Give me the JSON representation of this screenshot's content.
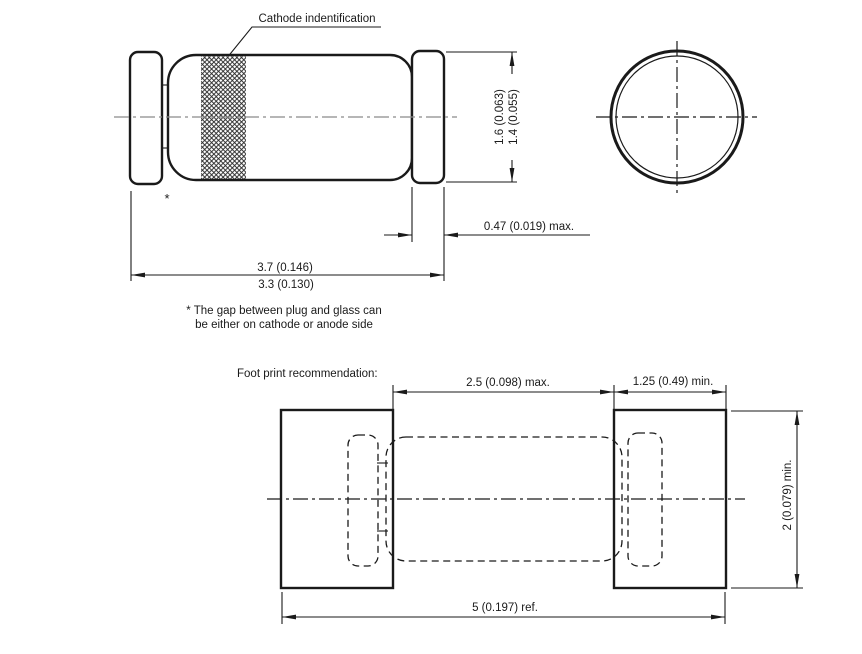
{
  "colors": {
    "line": "#1a1a1a",
    "centerline": "#8a8a8a"
  },
  "side_view": {
    "callout_label": "Cathode indentification",
    "gap_asterisk": "*",
    "dia_max": "1.6 (0.063)",
    "dia_min": "1.4 (0.055)",
    "cap_len": "0.47 (0.019) max.",
    "len_max": "3.7 (0.146)",
    "len_min": "3.3 (0.130)"
  },
  "note": {
    "line1": "* The gap between plug and glass can",
    "line2": "be either on cathode or anode side"
  },
  "footprint": {
    "title": "Foot print recommendation:",
    "pad_gap": "2.5 (0.098) max.",
    "pad_width": "1.25 (0.49) min.",
    "pad_height": "2 (0.079) min.",
    "overall": "5 (0.197) ref."
  }
}
